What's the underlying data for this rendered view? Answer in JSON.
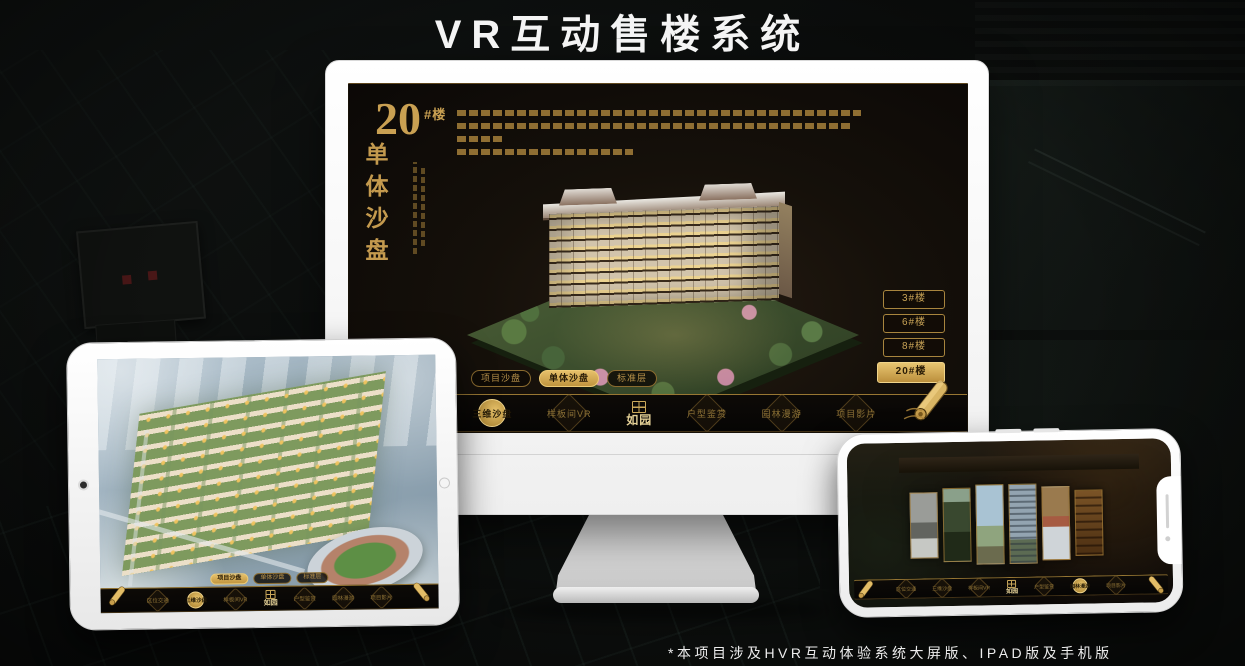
{
  "title": "VR互动售楼系统",
  "footnote": "*本项目涉及HVR互动体验系统大屏版、IPAD版及手机版",
  "colors": {
    "gold": "#c9a353",
    "gold_active": "#dfb95f",
    "screen_brown": "#1b140d",
    "frame_white": "#ffffff"
  },
  "nav": {
    "logo": "如园",
    "items": [
      {
        "label": "区位交通"
      },
      {
        "label": "三维沙盘"
      },
      {
        "label": "样板间VR"
      },
      {
        "label": "户型鉴赏"
      },
      {
        "label": "园林漫游"
      },
      {
        "label": "项目影片"
      }
    ]
  },
  "sub_tabs": [
    {
      "label": "项目沙盘"
    },
    {
      "label": "单体沙盘"
    },
    {
      "label": "标准层"
    }
  ],
  "monitor": {
    "headline": {
      "number": "20",
      "suffix": "#楼",
      "vertical": "单体沙盘"
    },
    "floor_buttons": [
      {
        "label": "3#楼",
        "active": false
      },
      {
        "label": "6#楼",
        "active": false
      },
      {
        "label": "8#楼",
        "active": false
      },
      {
        "label": "20#楼",
        "active": true
      }
    ],
    "active_sub_tab": "单体沙盘",
    "active_nav_item": "三维沙盘"
  },
  "tablet": {
    "active_sub_tab": "项目沙盘",
    "active_nav_item": "三维沙盘"
  },
  "phone": {
    "active_nav_item": "园林漫游"
  }
}
